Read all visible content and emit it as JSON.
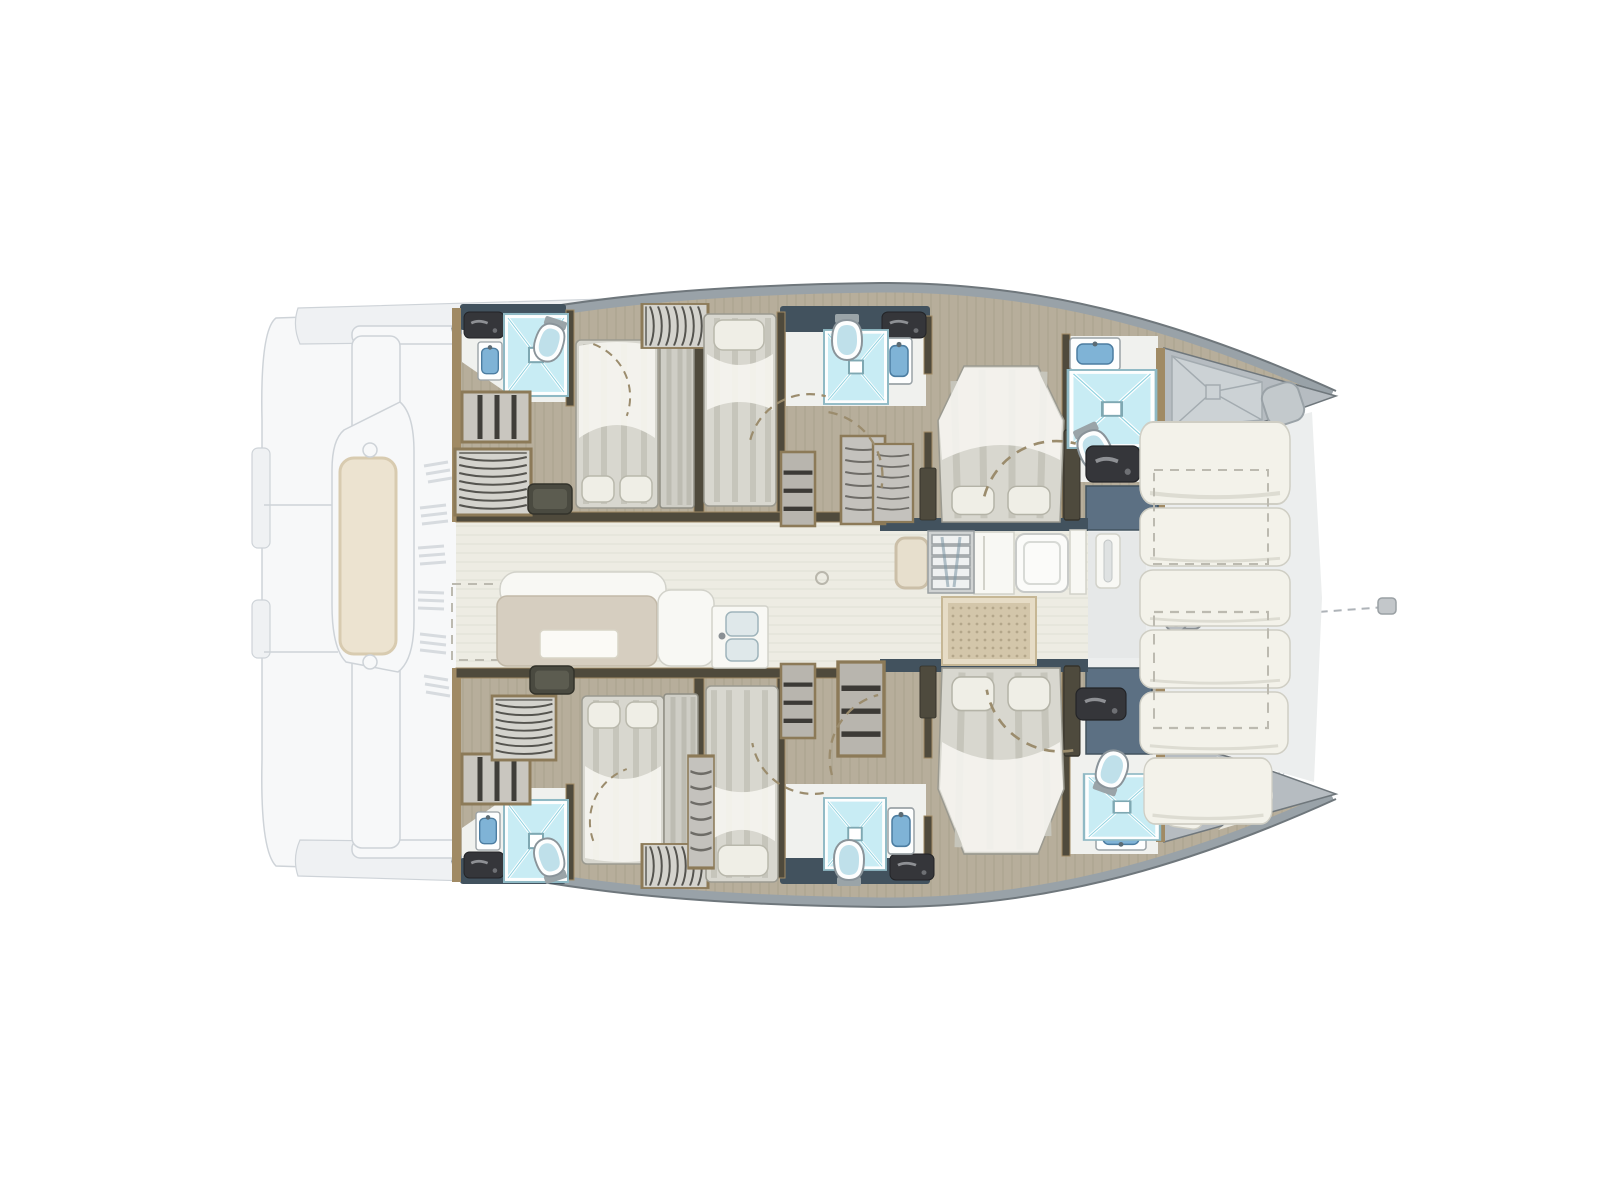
{
  "title": "Catamaran interior layout floor plan (top view)",
  "visible_text": [],
  "palette": {
    "floor_wood": "#b7ae9b",
    "floor_grain": "#9d937f",
    "floor_saloon": "#edece3",
    "deck_pale": "#eceeee",
    "bath_floor": "#f0f1ee",
    "wall_dark": "#4f4a3c",
    "wood_trim": "#a08a64",
    "panel_navy": "#42525e",
    "panel_bluegray": "#5c7083",
    "gunwale_gray": "#99a2a8",
    "hull_edge": "#6f777c",
    "forepeak_gray": "#b6bcc1",
    "tray_gray": "#ccd2d5",
    "tray_line": "#a3abb0",
    "ghost_fill": "#f7f8f9",
    "ghost_fill2": "#eff1f3",
    "ghost_line": "#ced3d8",
    "cushion_white": "#f3f2ea",
    "cushion_edge": "#cfcec4",
    "sofa_beige": "#d6cec0",
    "sofa_edge": "#c2b9a8",
    "pad_beige": "#ece3d0",
    "pad_border": "#d8cbb0",
    "mat_fill": "#d3c6aa",
    "mat_dot": "#b3a68a",
    "mat_border": "#e6dcc6",
    "mattress": "#d8d7cf",
    "mattress_stripe": "#c6c5bb",
    "duvet_white": "#f6f5f0",
    "pillow": "#efeee6",
    "shower_blue": "#c8ecf4",
    "shower_blue_deep": "#8fd2e0",
    "porcelain": "#fdfefe",
    "basin_blue": "#7fb3d6",
    "fixture_dark": "#35363a",
    "cab_gray": "#c9c6bf",
    "cab_line": "#5f5d56",
    "door_dash": "#9b8c6d"
  },
  "legend": {
    "vessel_type": "sailing-catamaran",
    "view": "deck-plan-top-view",
    "areas": [
      "aft-deck-ghost",
      "saloon",
      "galley",
      "forward-cockpit",
      "foredeck-lounge",
      "starboard-hull-cabins",
      "port-hull-cabins",
      "bow-forepeaks"
    ],
    "cabins": [
      {
        "name": "starboard-aft-double-cabin",
        "features": [
          "double-bed",
          "wardrobe",
          "shelves",
          "ensuite-shower",
          "toilet",
          "washbasin"
        ]
      },
      {
        "name": "starboard-mid-single-cabin",
        "features": [
          "single-bed",
          "wardrobe"
        ]
      },
      {
        "name": "starboard-mid-bathroom",
        "features": [
          "shower",
          "toilet",
          "washbasin"
        ]
      },
      {
        "name": "starboard-forward-double-cabin",
        "features": [
          "island-double-bed",
          "ensuite-shower",
          "toilet",
          "washbasin"
        ]
      },
      {
        "name": "starboard-forepeak",
        "features": [
          "shower-tray",
          "deck-hatch"
        ]
      },
      {
        "name": "port-aft-double-cabin",
        "features": [
          "double-bed",
          "wardrobe",
          "shelves",
          "ensuite-shower",
          "toilet",
          "washbasin"
        ]
      },
      {
        "name": "port-mid-single-cabin",
        "features": [
          "single-bed",
          "wardrobe"
        ]
      },
      {
        "name": "port-mid-bathroom",
        "features": [
          "shower",
          "toilet",
          "washbasin"
        ]
      },
      {
        "name": "port-forward-double-cabin",
        "features": [
          "island-double-bed",
          "ensuite-shower",
          "toilet",
          "washbasin"
        ]
      },
      {
        "name": "port-forepeak",
        "features": [
          "crew-berth-cushion"
        ]
      }
    ],
    "saloon_items": [
      "sofa",
      "table",
      "chaise-seat",
      "galley-sink",
      "companionway-steps",
      "doormat",
      "fridge"
    ],
    "foredeck_items": [
      "lounge-cushions",
      "storage-lockers-dashed",
      "windlass",
      "anchor-chain"
    ]
  },
  "fixtures": [
    {
      "type": "vanity",
      "name": "amenity-shelf-starboard-aft",
      "x": 464,
      "y": 312,
      "w": 40,
      "h": 26,
      "rot": 0
    },
    {
      "type": "sink",
      "name": "washbasin-starboard-aft",
      "x": 478,
      "y": 342,
      "w": 24,
      "h": 38,
      "rot": 0
    },
    {
      "type": "shower",
      "name": "shower-starboard-aft",
      "x": 504,
      "y": 314,
      "w": 64,
      "h": 82,
      "rot": 0
    },
    {
      "type": "toilet",
      "name": "toilet-starboard-aft",
      "x": 534,
      "y": 318,
      "w": 32,
      "h": 44,
      "rot": 18
    },
    {
      "type": "shelves",
      "name": "shelves-starboard-aft",
      "x": 462,
      "y": 392,
      "w": 68,
      "h": 50,
      "rot": 0
    },
    {
      "type": "wardrobe",
      "name": "wardrobe-starboard-aft",
      "x": 460,
      "y": 444,
      "w": 66,
      "h": 76,
      "rot": 90
    },
    {
      "type": "ottoman",
      "name": "ottoman-starboard-aft",
      "x": 528,
      "y": 484,
      "w": 44,
      "h": 30,
      "rot": 0
    },
    {
      "type": "bedDouble",
      "name": "double-bed-starboard-aft",
      "x": 576,
      "y": 340,
      "w": 82,
      "h": 168,
      "rot": 180
    },
    {
      "type": "bench",
      "name": "berth-bench-starboard-aft",
      "x": 660,
      "y": 342,
      "w": 34,
      "h": 166,
      "rot": 0
    },
    {
      "type": "wardrobe",
      "name": "hanging-locker-starboard-mid",
      "x": 642,
      "y": 304,
      "w": 66,
      "h": 44,
      "rot": 0
    },
    {
      "type": "bedSingle",
      "name": "single-bed-starboard",
      "x": 704,
      "y": 314,
      "w": 72,
      "h": 192,
      "rot": 0
    },
    {
      "type": "shelfCol",
      "name": "shelf-column-starboard",
      "x": 781,
      "y": 452,
      "w": 34,
      "h": 74,
      "rot": 0
    },
    {
      "type": "drawers",
      "name": "locker-starboard-corridor",
      "x": 841,
      "y": 436,
      "w": 44,
      "h": 88,
      "rot": 0
    },
    {
      "type": "drawers",
      "name": "locker-starboard-fore",
      "x": 873,
      "y": 444,
      "w": 40,
      "h": 78,
      "rot": 0
    },
    {
      "type": "vanity",
      "name": "amenity-shelf-starboard-mid",
      "x": 882,
      "y": 312,
      "w": 44,
      "h": 26,
      "rot": 0
    },
    {
      "type": "sink",
      "name": "washbasin-starboard-mid",
      "x": 886,
      "y": 338,
      "w": 26,
      "h": 46,
      "rot": 0
    },
    {
      "type": "shower",
      "name": "shower-starboard-mid",
      "x": 824,
      "y": 330,
      "w": 64,
      "h": 74,
      "rot": 0
    },
    {
      "type": "toilet",
      "name": "toilet-starboard-mid",
      "x": 830,
      "y": 314,
      "w": 34,
      "h": 46,
      "rot": 0
    },
    {
      "type": "bedIsland",
      "name": "island-bed-starboard-forward",
      "x": 938,
      "y": 366,
      "w": 126,
      "h": 156,
      "rot": 180
    },
    {
      "type": "nightstand",
      "name": "nightstand-starboard-a",
      "x": 920,
      "y": 468,
      "w": 16,
      "h": 52,
      "rot": 0
    },
    {
      "type": "nightstand",
      "name": "nightstand-starboard-b",
      "x": 1064,
      "y": 430,
      "w": 16,
      "h": 90,
      "rot": 0
    },
    {
      "type": "sinkWide",
      "name": "washbasin-starboard-forward",
      "x": 1070,
      "y": 338,
      "w": 50,
      "h": 32,
      "rot": 0
    },
    {
      "type": "shower",
      "name": "shower-starboard-forward",
      "x": 1068,
      "y": 370,
      "w": 88,
      "h": 78,
      "rot": 0
    },
    {
      "type": "toilet",
      "name": "toilet-starboard-forward",
      "x": 1076,
      "y": 424,
      "w": 36,
      "h": 48,
      "rot": -25
    },
    {
      "type": "vanity",
      "name": "amenity-starboard-forward",
      "x": 1086,
      "y": 446,
      "w": 54,
      "h": 36,
      "rot": 0
    },
    {
      "type": "vanity",
      "name": "amenity-shelf-port-aft",
      "x": 464,
      "y": 852,
      "w": 40,
      "h": 26,
      "rot": 0
    },
    {
      "type": "sink",
      "name": "washbasin-port-aft",
      "x": 476,
      "y": 812,
      "w": 24,
      "h": 38,
      "rot": 0
    },
    {
      "type": "shower",
      "name": "shower-port-aft",
      "x": 504,
      "y": 800,
      "w": 64,
      "h": 82,
      "rot": 0
    },
    {
      "type": "toilet",
      "name": "toilet-port-aft",
      "x": 534,
      "y": 838,
      "w": 32,
      "h": 44,
      "rot": 162
    },
    {
      "type": "shelves",
      "name": "shelves-port-aft",
      "x": 462,
      "y": 754,
      "w": 68,
      "h": 50,
      "rot": 0
    },
    {
      "type": "wardrobe",
      "name": "wardrobe-port-aft",
      "x": 492,
      "y": 696,
      "w": 64,
      "h": 64,
      "rot": 90
    },
    {
      "type": "ottoman",
      "name": "ottoman-port-aft",
      "x": 530,
      "y": 666,
      "w": 44,
      "h": 28,
      "rot": 0
    },
    {
      "type": "bedDouble",
      "name": "double-bed-port-aft",
      "x": 582,
      "y": 696,
      "w": 82,
      "h": 168,
      "rot": 0
    },
    {
      "type": "bench",
      "name": "berth-bench-port-aft",
      "x": 664,
      "y": 694,
      "w": 34,
      "h": 166,
      "rot": 0
    },
    {
      "type": "wardrobe",
      "name": "hanging-locker-port-mid",
      "x": 642,
      "y": 844,
      "w": 66,
      "h": 44,
      "rot": 0
    },
    {
      "type": "bedSingle",
      "name": "single-bed-port",
      "x": 706,
      "y": 686,
      "w": 72,
      "h": 196,
      "rot": 180
    },
    {
      "type": "shelfCol",
      "name": "shelf-column-port",
      "x": 781,
      "y": 664,
      "w": 34,
      "h": 74,
      "rot": 0
    },
    {
      "type": "drawers",
      "name": "locker-port-corridor",
      "x": 688,
      "y": 756,
      "w": 26,
      "h": 112,
      "rot": 0
    },
    {
      "type": "shelfCol",
      "name": "open-shelves-port-fore",
      "x": 838,
      "y": 662,
      "w": 46,
      "h": 94,
      "rot": 0
    },
    {
      "type": "vanity",
      "name": "amenity-shelf-port-mid",
      "x": 890,
      "y": 854,
      "w": 44,
      "h": 26,
      "rot": 0
    },
    {
      "type": "sink",
      "name": "washbasin-port-mid",
      "x": 888,
      "y": 808,
      "w": 26,
      "h": 46,
      "rot": 0
    },
    {
      "type": "shower",
      "name": "shower-port-mid",
      "x": 824,
      "y": 798,
      "w": 62,
      "h": 72,
      "rot": 0
    },
    {
      "type": "toilet",
      "name": "toilet-port-mid",
      "x": 832,
      "y": 840,
      "w": 34,
      "h": 46,
      "rot": 180
    },
    {
      "type": "bedIsland",
      "name": "island-bed-port-forward",
      "x": 938,
      "y": 668,
      "w": 126,
      "h": 186,
      "rot": 0
    },
    {
      "type": "nightstand",
      "name": "nightstand-port-a",
      "x": 920,
      "y": 666,
      "w": 16,
      "h": 52,
      "rot": 0
    },
    {
      "type": "nightstand",
      "name": "nightstand-port-b",
      "x": 1064,
      "y": 666,
      "w": 16,
      "h": 90,
      "rot": 0
    },
    {
      "type": "sinkWide",
      "name": "washbasin-port-forward",
      "x": 1096,
      "y": 820,
      "w": 50,
      "h": 30,
      "rot": 180
    },
    {
      "type": "shower",
      "name": "shower-port-forward",
      "x": 1084,
      "y": 774,
      "w": 76,
      "h": 66,
      "rot": 0
    },
    {
      "type": "toilet",
      "name": "toilet-port-forward",
      "x": 1094,
      "y": 750,
      "w": 34,
      "h": 44,
      "rot": 200
    },
    {
      "type": "vanity",
      "name": "amenity-port-forward",
      "x": 1076,
      "y": 688,
      "w": 50,
      "h": 32,
      "rot": 0
    },
    {
      "type": "steps",
      "name": "companionway-steps",
      "x": 928,
      "y": 531,
      "w": 46,
      "h": 62,
      "rot": 0
    },
    {
      "type": "mat",
      "name": "saloon-doormat",
      "x": 942,
      "y": 597,
      "w": 94,
      "h": 68,
      "rot": 0
    },
    {
      "type": "windlass",
      "name": "anchor-windlass",
      "x": 1162,
      "y": 606,
      "w": 48,
      "h": 30,
      "rot": 0
    },
    {
      "type": "cushion",
      "name": "foredeck-cushion-1",
      "x": 1140,
      "y": 422,
      "w": 150,
      "h": 82,
      "rot": 0
    },
    {
      "type": "cushion",
      "name": "foredeck-cushion-2",
      "x": 1140,
      "y": 508,
      "w": 150,
      "h": 58,
      "rot": 0
    },
    {
      "type": "cushion",
      "name": "foredeck-cushion-3",
      "x": 1140,
      "y": 570,
      "w": 150,
      "h": 56,
      "rot": 0
    },
    {
      "type": "cushion",
      "name": "foredeck-cushion-4",
      "x": 1140,
      "y": 630,
      "w": 150,
      "h": 58,
      "rot": 0
    },
    {
      "type": "cushion",
      "name": "foredeck-cushion-5",
      "x": 1140,
      "y": 692,
      "w": 148,
      "h": 62,
      "rot": 0
    },
    {
      "type": "cushion",
      "name": "foredeck-cushion-6",
      "x": 1144,
      "y": 758,
      "w": 128,
      "h": 66,
      "rot": 0
    },
    {
      "type": "dashedLocker",
      "name": "foredeck-locker-a",
      "x": 1154,
      "y": 470,
      "w": 114,
      "h": 94,
      "rot": 0
    },
    {
      "type": "dashedLocker",
      "name": "foredeck-locker-b",
      "x": 1154,
      "y": 612,
      "w": 114,
      "h": 116,
      "rot": 0
    },
    {
      "type": "doorArc",
      "name": "door-swing-s1",
      "x": 580,
      "y": 350,
      "w": 60,
      "h": 60,
      "rot": 110
    },
    {
      "type": "doorArc",
      "name": "door-swing-s2",
      "x": 755,
      "y": 385,
      "w": 66,
      "h": 66,
      "rot": 15
    },
    {
      "type": "doorArc",
      "name": "door-swing-s3",
      "x": 820,
      "y": 415,
      "w": 70,
      "h": 70,
      "rot": 100
    },
    {
      "type": "doorArc",
      "name": "door-swing-s4",
      "x": 990,
      "y": 430,
      "w": 80,
      "h": 80,
      "rot": 15
    },
    {
      "type": "doorArc",
      "name": "door-swing-p1",
      "x": 580,
      "y": 775,
      "w": 60,
      "h": 60,
      "rot": -20
    },
    {
      "type": "doorArc",
      "name": "door-swing-p2",
      "x": 755,
      "y": 735,
      "w": 66,
      "h": 66,
      "rot": -100
    },
    {
      "type": "doorArc",
      "name": "door-swing-p3",
      "x": 820,
      "y": 700,
      "w": 70,
      "h": 70,
      "rot": -15
    },
    {
      "type": "doorArc",
      "name": "door-swing-p4",
      "x": 990,
      "y": 680,
      "w": 80,
      "h": 80,
      "rot": -100
    }
  ]
}
